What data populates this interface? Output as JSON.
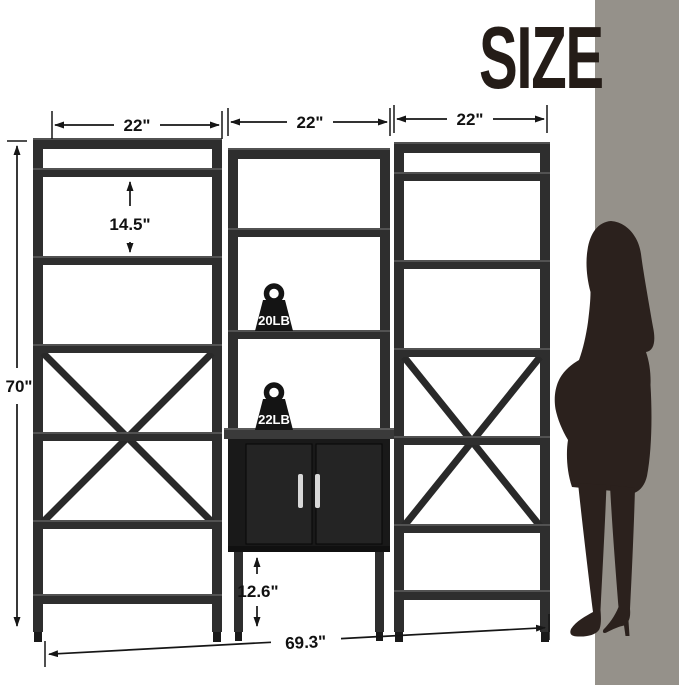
{
  "title": "SIZE",
  "dimensions": {
    "left_width": "22\"",
    "middle_width": "22\"",
    "right_width": "22\"",
    "tier_height": "14.5\"",
    "total_height": "70\"",
    "bottom_clearance": "12.6\"",
    "total_width": "69.3\""
  },
  "load_labels": {
    "middle_shelf": "20LB",
    "cabinet_top": "22LB"
  },
  "icons": {
    "weight_upper": "weight-icon",
    "weight_lower": "weight-icon",
    "figure": "woman-silhouette-icon"
  },
  "colors": {
    "wall": "#95918a",
    "frame": "#2e2e2e",
    "cabinet": "#191919",
    "handle": "#d8d8d8",
    "silhouette": "#2b211d",
    "dimension_ink": "#161616",
    "title_ink": "#241c17"
  }
}
